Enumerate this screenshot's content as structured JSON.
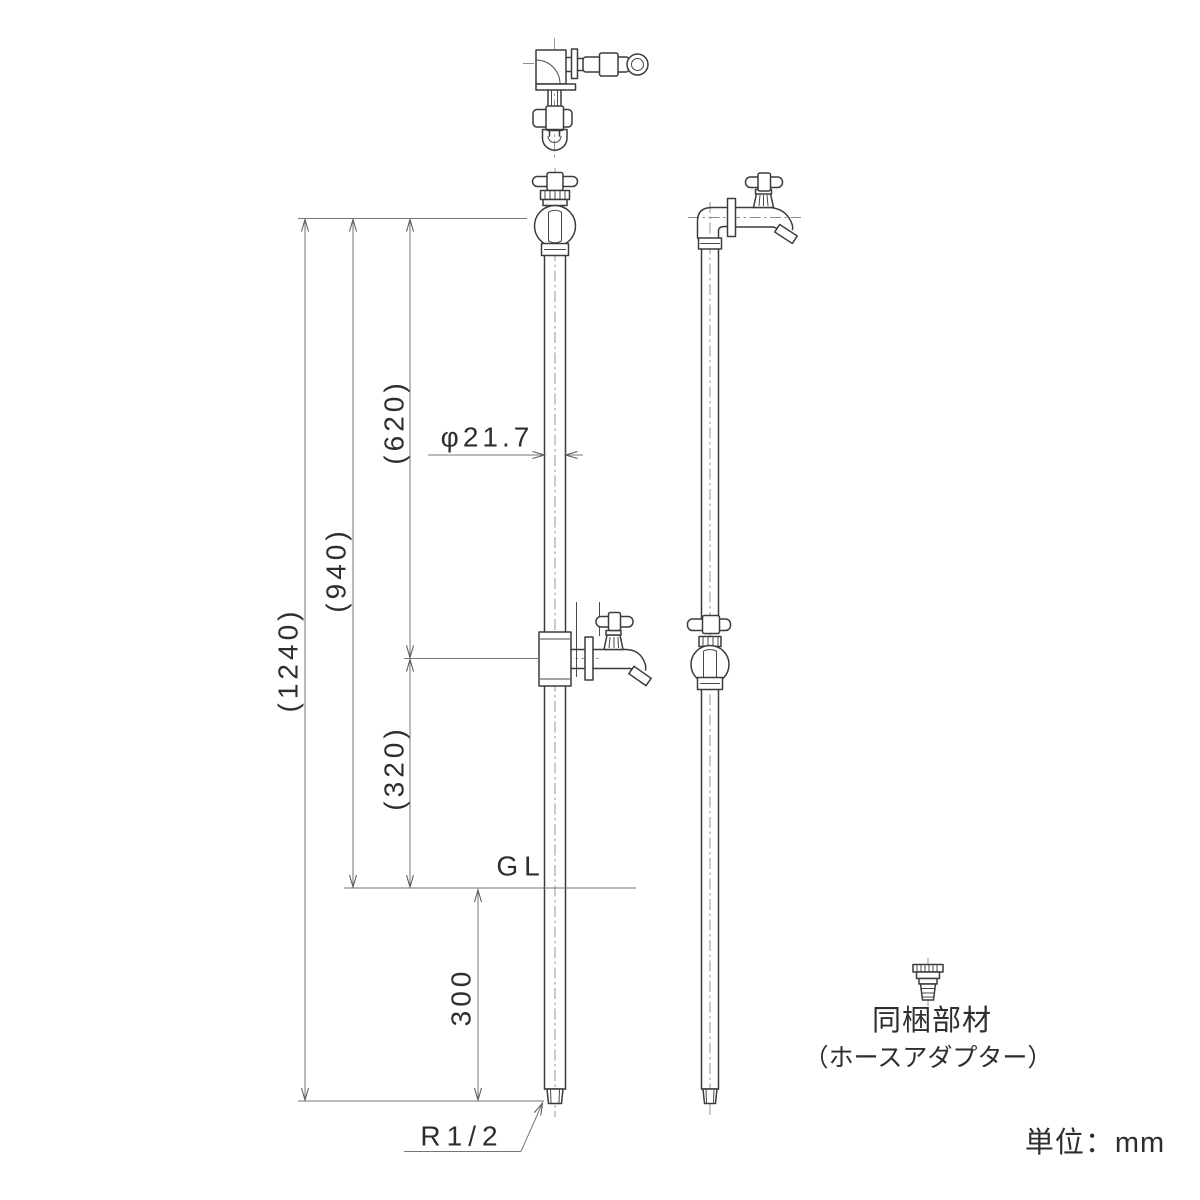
{
  "drawing": {
    "dimensions": {
      "total_height": "(1240)",
      "top_to_gl": "(940)",
      "top_to_branch": "(620)",
      "branch_to_gl": "(320)",
      "below_gl": "300",
      "pipe_diameter": "φ21.7",
      "ground_level": "GL",
      "thread_size": "R1/2"
    },
    "included_parts": {
      "title": "同梱部材",
      "name": "（ホースアダプター）"
    },
    "unit_note": "単位：mm"
  }
}
